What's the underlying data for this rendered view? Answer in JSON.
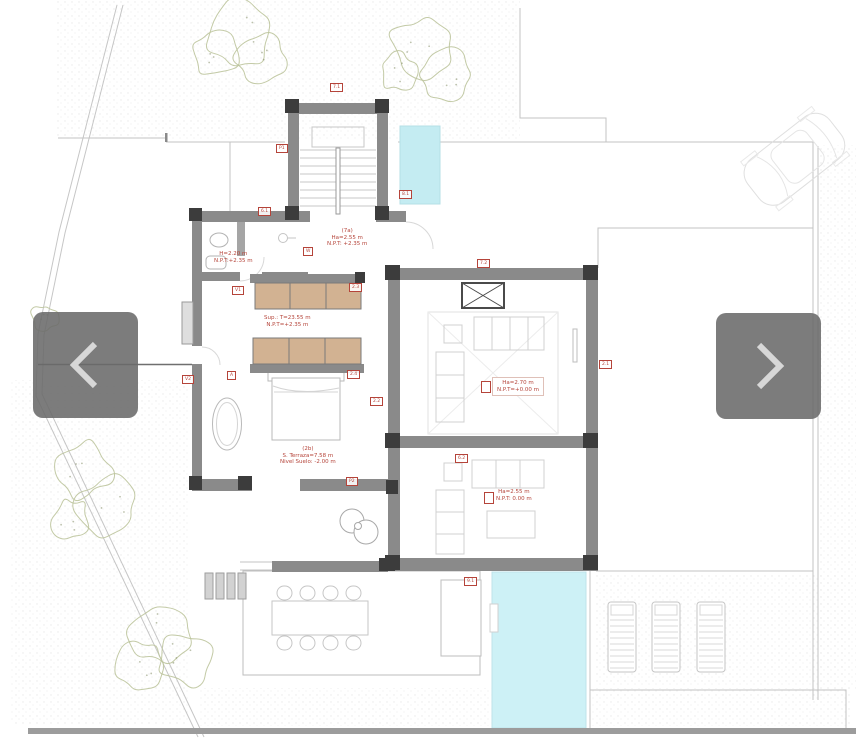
{
  "viewer": {
    "prev_label": "Previous image",
    "next_label": "Next image",
    "overlay_color": "#6a6a6a",
    "chevron_color": "#d7d7d7"
  },
  "plan": {
    "title": "First floor plan",
    "colors": {
      "wall": "#8a8a8a",
      "column": "#3c3c3c",
      "pool": "#c9eff5",
      "wardrobe": "#d2b292",
      "annotation_red": "#b5443a",
      "tree": "#bcc49c",
      "bottom_bar": "#9c9c9c"
    },
    "tags": [
      {
        "label": "7.1",
        "x": 330,
        "y": 83
      },
      {
        "label": "P1",
        "x": 276,
        "y": 144
      },
      {
        "label": "6.1",
        "x": 258,
        "y": 207
      },
      {
        "label": "8.1",
        "x": 399,
        "y": 190
      },
      {
        "label": "W",
        "x": 303,
        "y": 247
      },
      {
        "label": "2.3",
        "x": 349,
        "y": 283
      },
      {
        "label": "V1",
        "x": 232,
        "y": 286
      },
      {
        "label": "7.2",
        "x": 477,
        "y": 259
      },
      {
        "label": "2.1",
        "x": 599,
        "y": 360
      },
      {
        "label": "A",
        "x": 227,
        "y": 371
      },
      {
        "label": "2.4",
        "x": 347,
        "y": 370
      },
      {
        "label": "2.2",
        "x": 370,
        "y": 397
      },
      {
        "label": "V2",
        "x": 182,
        "y": 375
      },
      {
        "label": "6.2",
        "x": 455,
        "y": 454
      },
      {
        "label": "9.1",
        "x": 464,
        "y": 577
      },
      {
        "label": "P2",
        "x": 346,
        "y": 477
      }
    ],
    "notes": [
      {
        "id": "hall",
        "x": 327,
        "y": 228,
        "lines": [
          "(7a)",
          "Ha=2.55 m",
          "N.P.T: +2.35 m"
        ]
      },
      {
        "id": "bath",
        "x": 214,
        "y": 251,
        "lines": [
          "H=2.20 m",
          "N.P.T:+2.35 m"
        ]
      },
      {
        "id": "dressing",
        "x": 264,
        "y": 315,
        "lines": [
          "Sup.: T=23.55 m",
          "N.P.T=+2.35 m"
        ]
      },
      {
        "id": "bigroom",
        "x": 492,
        "y": 377,
        "boxed": true,
        "prefix": true,
        "lines": [
          "Ha=2.70 m",
          "N.P.T=+0.00 m"
        ]
      },
      {
        "id": "lowroom",
        "x": 496,
        "y": 489,
        "prefix": true,
        "lines": [
          "Ha=2.55 m",
          "N.P.T: 0.00 m"
        ]
      },
      {
        "id": "bedroom",
        "x": 280,
        "y": 446,
        "lines": [
          "(2b)",
          "S. Terraza=7.58 m",
          "Nivel Suelo: -2.00 m"
        ]
      }
    ]
  }
}
